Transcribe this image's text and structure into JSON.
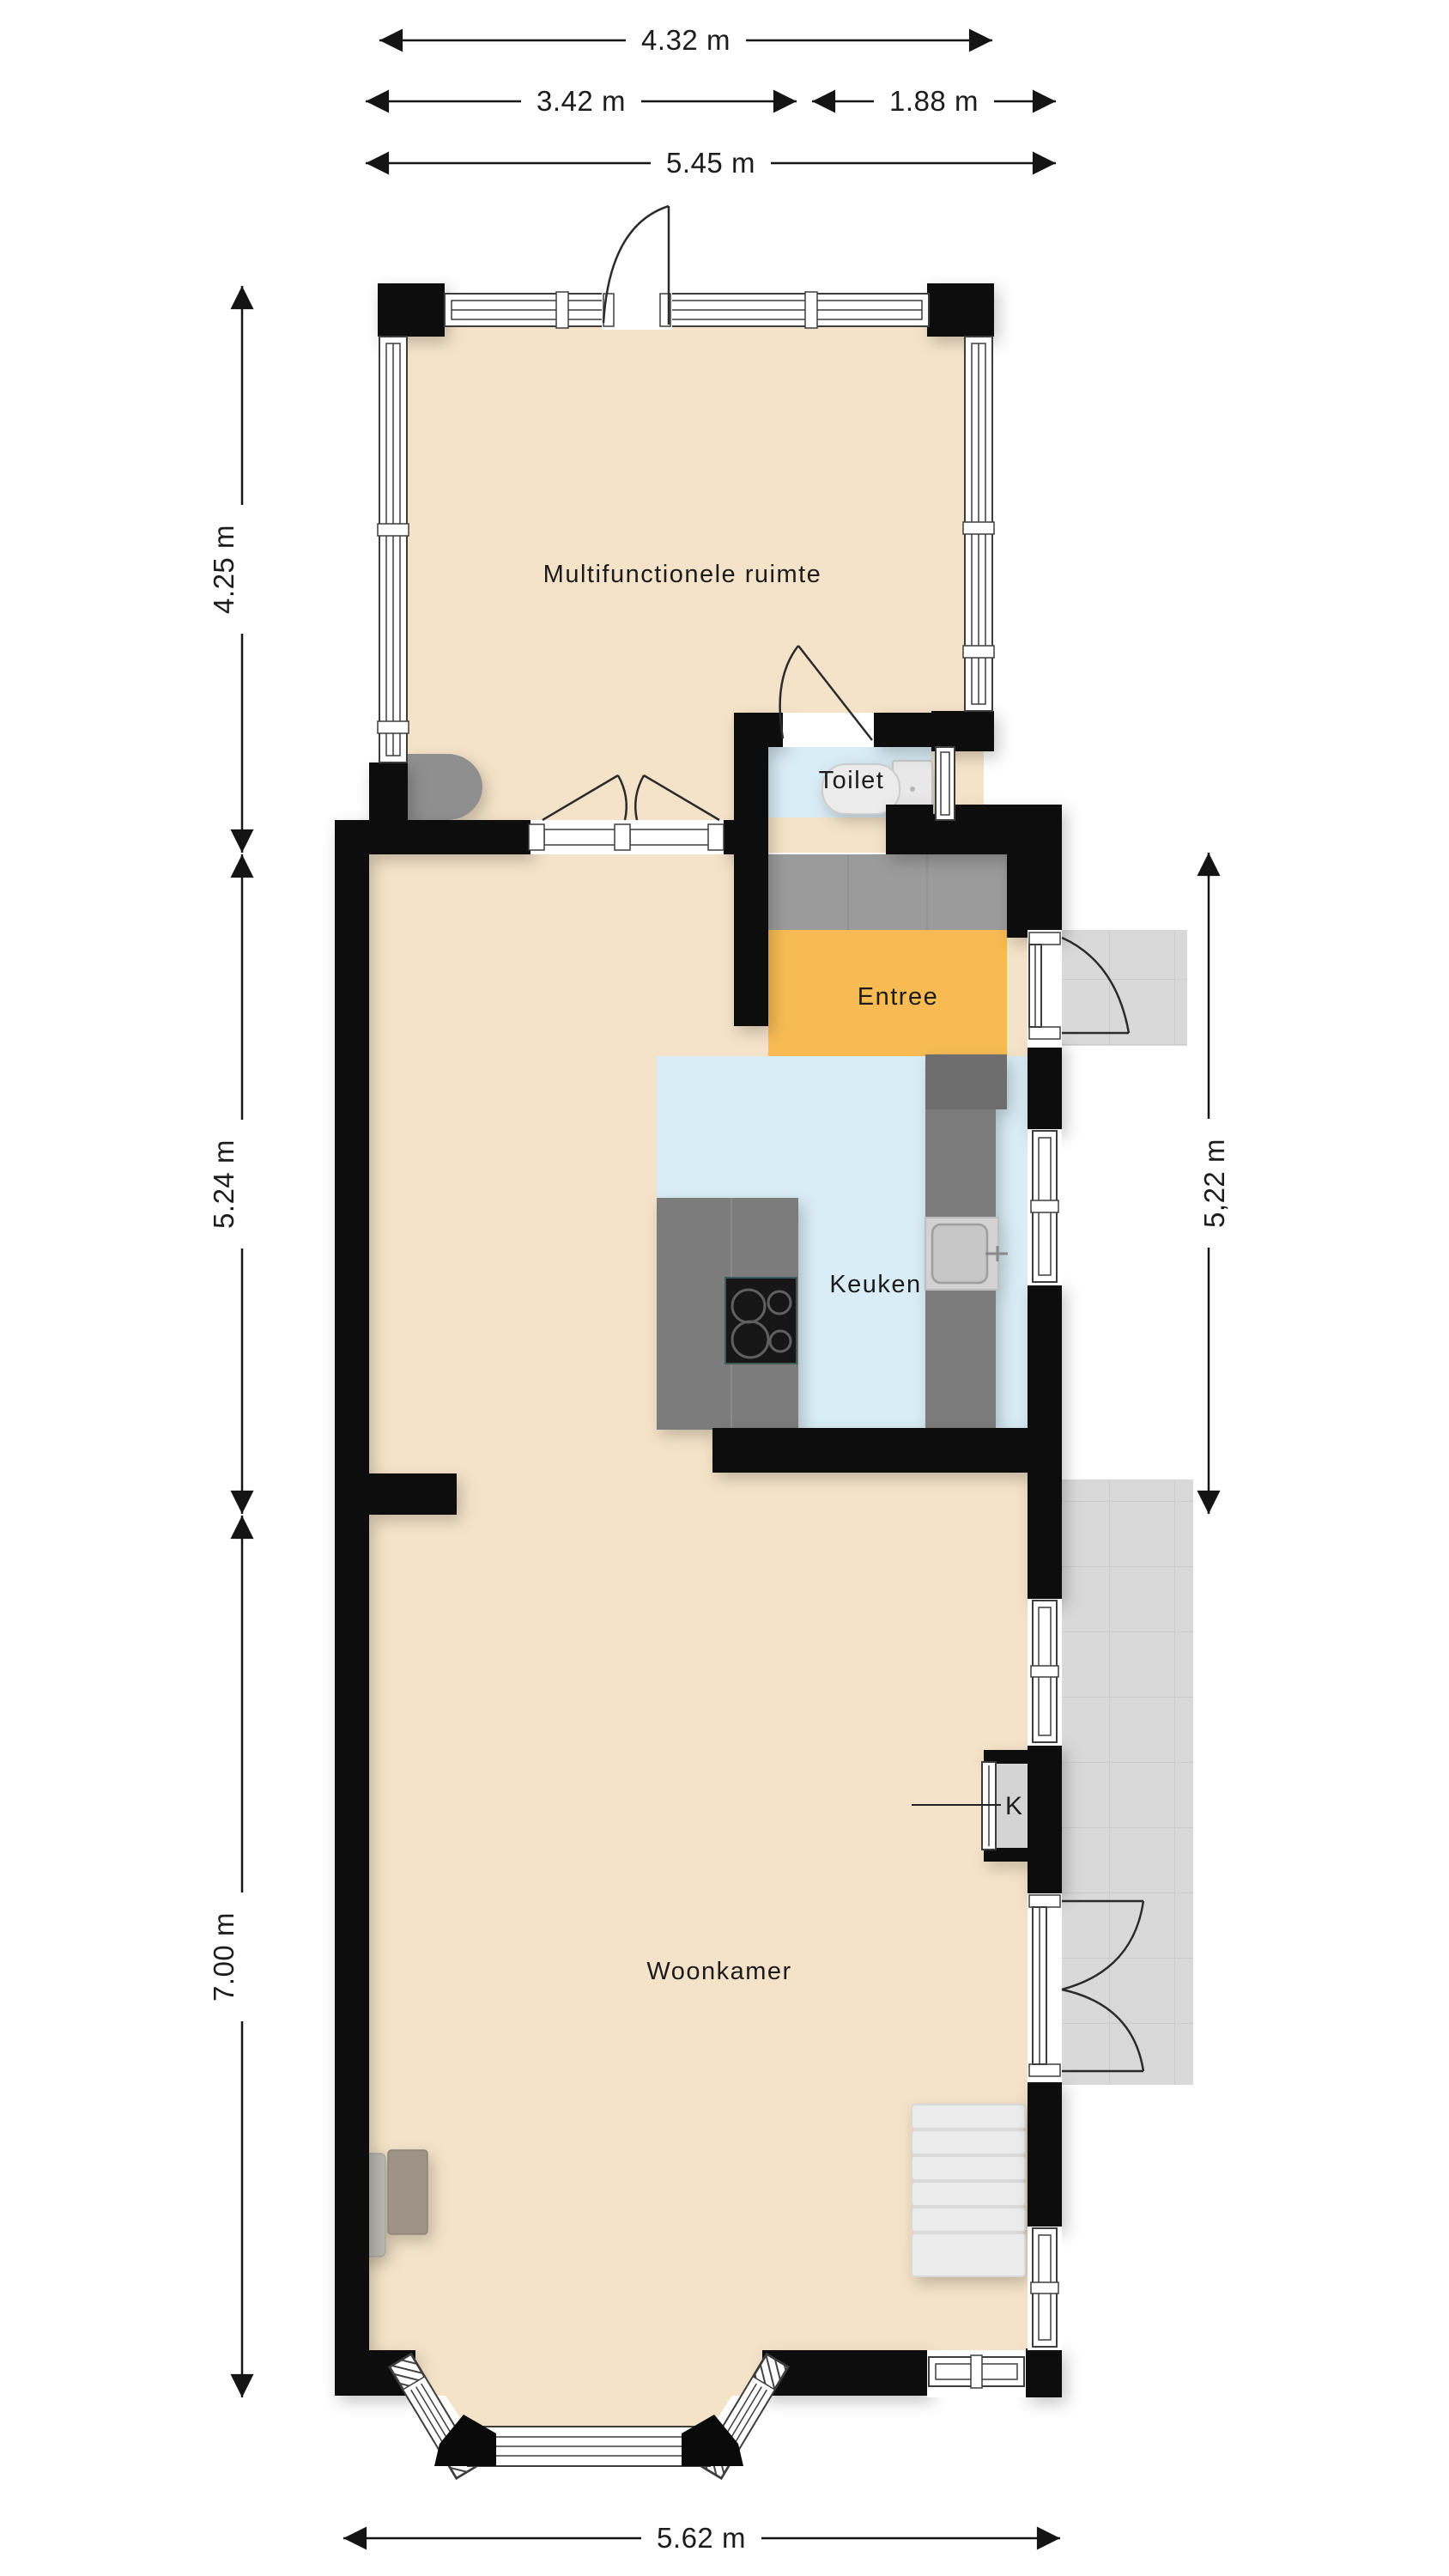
{
  "plan": {
    "type": "floor-plan",
    "rooms": {
      "multifunctionele_ruimte": {
        "label": "Multifunctionele ruimte"
      },
      "toilet": {
        "label": "Toilet"
      },
      "entree": {
        "label": "Entree"
      },
      "keuken": {
        "label": "Keuken"
      },
      "woonkamer": {
        "label": "Woonkamer"
      },
      "kast": {
        "label": "K"
      }
    },
    "dimensions": {
      "annex_width": "4.32 m",
      "top_width_left": "3.42 m",
      "top_width_right": "1.88 m",
      "top_width_total": "5.45 m",
      "annex_height": "4.25 m",
      "middle_height_left": "5.24 m",
      "middle_height_right": "5,22 m",
      "living_height": "7.00 m",
      "bottom_width_total": "5.62 m"
    },
    "colors": {
      "wall": "#0a0a0a",
      "floor_beige": "#f5e3c9",
      "floor_wet_blue": "#d9edf6",
      "floor_entree_orange": "#f8bb54",
      "mat_gray": "#9b9b9b",
      "counter_gray": "#7a7a7a",
      "terrace_gray": "#d9d9d9"
    }
  }
}
